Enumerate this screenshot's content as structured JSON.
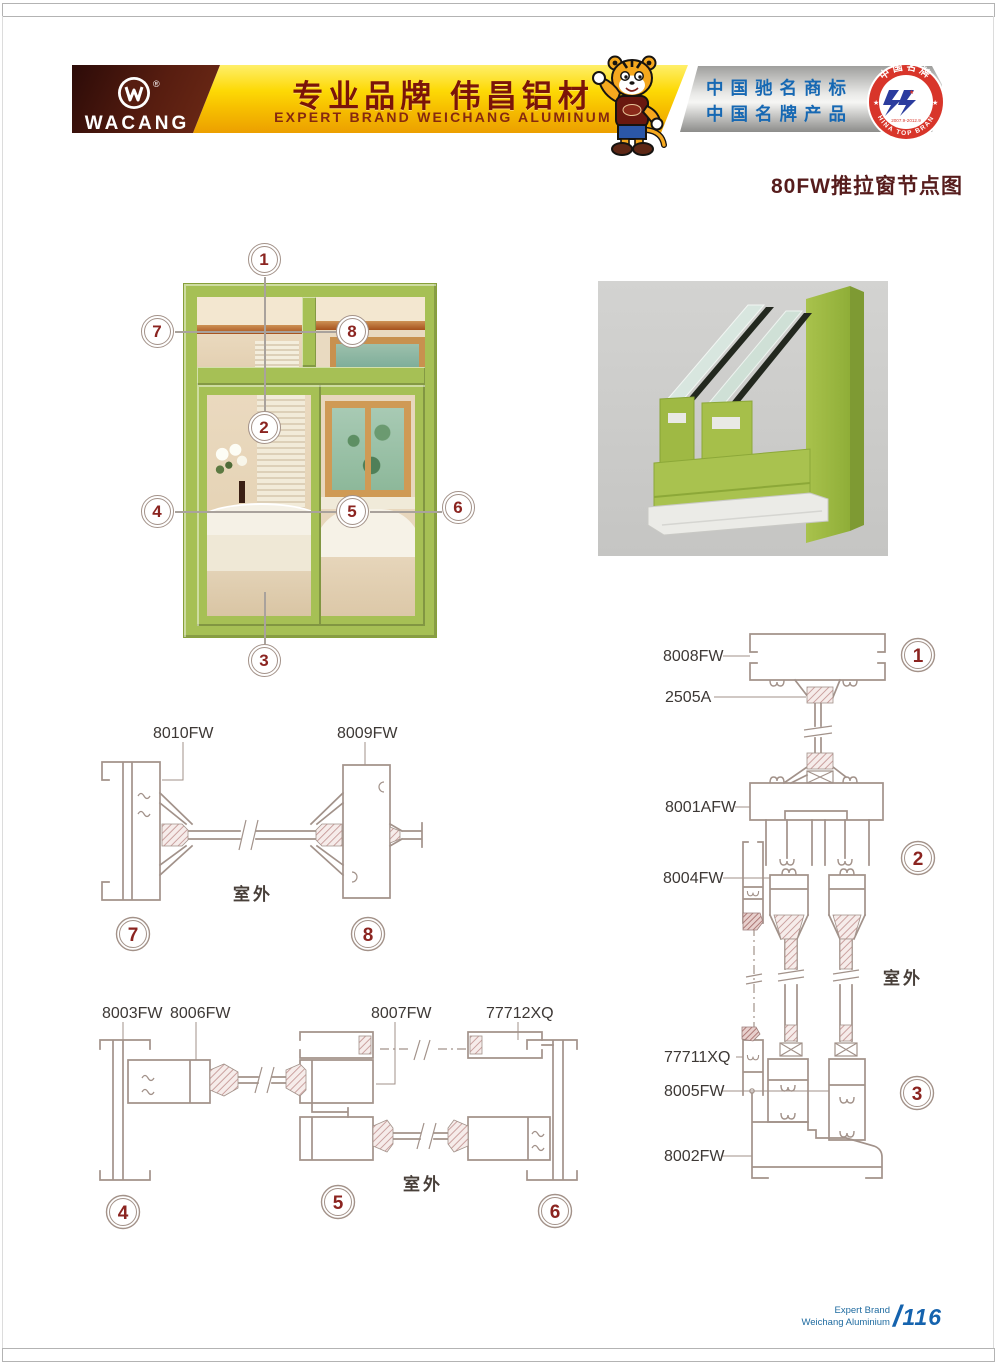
{
  "page": {
    "title": "80FW推拉窗节点图",
    "footer": {
      "line1": "Expert Brand",
      "line2": "Weichang Aluminium",
      "slash": "/",
      "number": "116"
    }
  },
  "header": {
    "logo": {
      "text": "WACANG",
      "reg": "®"
    },
    "slogan_cn": "专业品牌  伟昌铝材",
    "slogan_en": "EXPERT BRAND WEICHANG ALUMINUM",
    "honors": {
      "line1": "中国驰名商标",
      "line2": "中国名牌产品"
    },
    "badge": {
      "top": "中国名牌",
      "bottom": "CHINA TOP BRAND",
      "dates": "2007.9-2012.9"
    }
  },
  "window_diagram": {
    "callouts": [
      "1",
      "2",
      "3",
      "4",
      "5",
      "6",
      "7",
      "8"
    ]
  },
  "sections": {
    "s78": {
      "labels": [
        "8010FW",
        "8009FW"
      ],
      "outdoor": "室外",
      "callouts": [
        "7",
        "8"
      ]
    },
    "s456": {
      "labels": [
        "8003FW",
        "8006FW",
        "8007FW",
        "77712XQ"
      ],
      "outdoor": "室外",
      "callouts": [
        "4",
        "5",
        "6"
      ]
    },
    "s123": {
      "labels": [
        "8008FW",
        "2505A",
        "8001AFW",
        "8004FW",
        "77711XQ",
        "8005FW",
        "8002FW"
      ],
      "outdoor": "室外",
      "callouts": [
        "1",
        "2",
        "3"
      ]
    }
  },
  "colors": {
    "accent_maroon": "#561c1c",
    "banner_yellow": "#fdd905",
    "honor_blue": "#1668b3",
    "drawing_line": "#a2928a",
    "callout_red": "#8b2420",
    "window_green": "#a6c055",
    "footer_blue": "#1563ae",
    "badge_red": "#d8352a"
  }
}
